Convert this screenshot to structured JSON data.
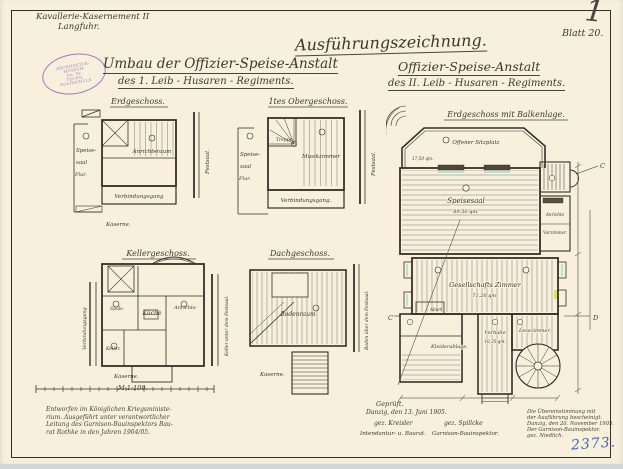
{
  "header": {
    "unit_line1": "Kavallerie-Kasernement II",
    "unit_line2": "Langfuhr.",
    "main_title": "Ausführungszeichnung.",
    "sheet_label": "Blatt 20.",
    "corner_mark": "1",
    "title_left_1": "Umbau der Offizier-Speise-Anstalt",
    "title_left_2": "des 1.  Leib - Husaren - Regiments.",
    "title_right_1": "Offizier-Speise-Anstalt",
    "title_right_2": "des II.  Leib - Husaren - Regiments.",
    "stamp": {
      "top": "ARCHITEKTUR-MUSEUM",
      "middle": "Inv. Nr.",
      "bottom": "TECHN. HOCHSCHULE"
    }
  },
  "plans": {
    "erdgeschoss": {
      "title": "Erdgeschoss.",
      "speisesaal1": "Speise-",
      "speisesaal2": "saal",
      "flur": "Flur.",
      "anrichteraum": "Anrichteraum",
      "gang": "Verbindungsgang",
      "festsaal": "Festsaal.",
      "kaserne": "Kaserne."
    },
    "obergeschoss": {
      "title": "1tes Obergeschoss.",
      "treppe": "Treppe.",
      "speisesaal1": "Speise-",
      "speisesaal2": "saal",
      "flur": "Flur.",
      "musikzimmer": "Musikzimmer",
      "gang": "Verbindungsgang.",
      "festsaal": "Festsaal."
    },
    "kellergeschoss": {
      "title": "Kellergeschoss.",
      "spuele": "Spüle.",
      "kueche": "Küche",
      "anrichte": "Anrichte",
      "keller": "Keller.",
      "gang": "Verbindungsgang",
      "seite": "Keller unter dem Festsaal.",
      "kaserne": "Kaserne.",
      "scale": "M 1:100."
    },
    "dachgeschoss": {
      "title": "Dachgeschoss.",
      "bodenraum": "Bodenraum",
      "seite": "Boden über dem Festsaal.",
      "kaserne": "Kaserne."
    },
    "hauptplan": {
      "title": "Erdgeschoss mit Balkenlage.",
      "sitzplatz": "Offener Sitzplatz",
      "sitzplatz_qm": "17,50 qm.",
      "speisesaal": "Speisesaal",
      "speisesaal_qm": "89,50 qm.",
      "anrichte": "Anrichte",
      "vorzimmer": "Vorzimmer.",
      "gesellschaft": "Gesellschafts  Zimmer",
      "gesellschaft_qm": "71,20 qm.",
      "abort": "Abort.",
      "kleiderablage": "Kleiderablage.",
      "vorhalle": "Vorhalle",
      "vorhalle_qm": "10,35 qm.",
      "lesezimmer": "Lesezimmer.",
      "section_c": "C",
      "section_d": "D"
    }
  },
  "footer": {
    "left1": "Entworfen im Königlichen Kriegsministe-",
    "left2": "rium.  Ausgeführt unter verantwortlicher",
    "left3": "Leitung des Garnison-Bauinspektors Bau-",
    "left4": "rat Rothke in den Jahren 1904/05.",
    "geprueft": "Geprüft.",
    "datum": "Danzig, den 13. Juni 1905.",
    "sig_left": "gez. Kreisler",
    "sig_right": "gez. Spillcke",
    "role_left": "Intendantur- u. Baurat.",
    "role_right": "Garnison-Bauinspektor.",
    "right1": "Die Übereinstimmung mit",
    "right2": "der Ausführung bescheinigt.",
    "right3": "Danzig, den 20. November 1905.",
    "right4": "Der Garnison-Bauinspektor.",
    "right5": "gez. Niedlich.",
    "archive_no": "2373."
  }
}
